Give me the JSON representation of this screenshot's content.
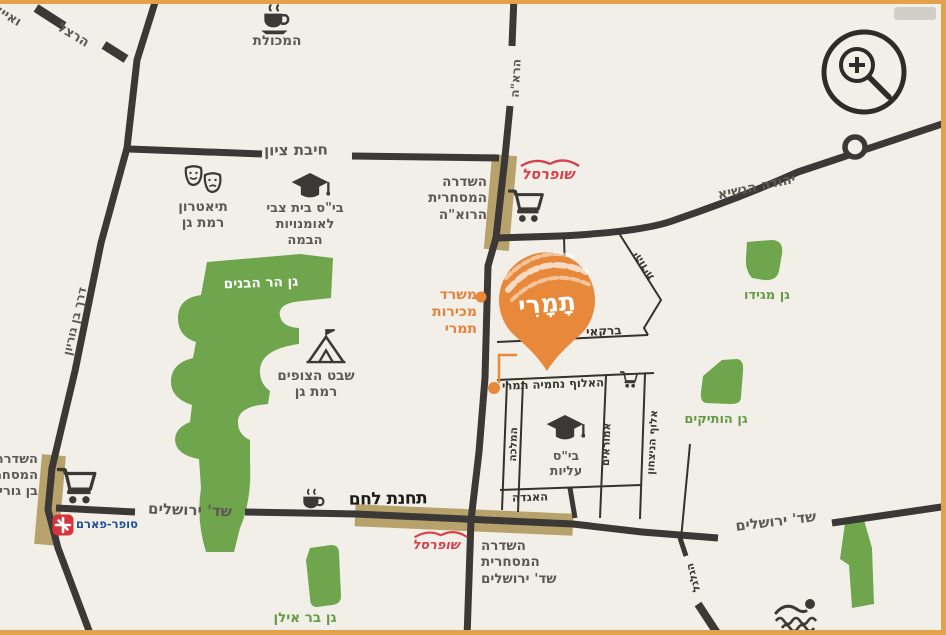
{
  "streets": {
    "ayalon": "ואיילון",
    "herzl": "הרצל",
    "hibat_zion": "חיבת ציון",
    "haroe": "הרא\"ה",
    "yehuda_hanasi": "יהודה הנשיא",
    "ben_gurion": "דרך בן גוריון",
    "barkai": "ברקאי",
    "yehudit": "יהודית",
    "nahmia_tamari": "האלוף נחמיה תמרי",
    "hamalka": "המלכה",
    "amoraim": "אמוראים",
    "aluf_hanitzachon": "אלוף הניצחון",
    "haagada": "האגדה",
    "jerusalem_left": "שד' ירושלים",
    "jerusalem_right": "שד' ירושלים",
    "hagalgal": "הגלגל"
  },
  "places": {
    "hamakolet": "המכולת",
    "theater": "תיאטרון\nרמת גן",
    "beit_zvi": "בי\"ס בית צבי\nלאומנויות\nהבמה",
    "shufersal_top": "שופרסל",
    "shufersal_bottom": "שופרסל",
    "promenade_haroe": "השדרה\nהמסחרית\nהרוא\"ה",
    "sales_office": "משרד\nמכירות\nתמרי",
    "gan_har_habanim": "גן הר הבנים",
    "scouts": "שבט הצופים\nרמת גן",
    "gan_megido": "גן מגידו",
    "gan_havatikim": "גן הותיקים",
    "school_aliyot": "בי\"ס\nעליות",
    "tahanat_lehem": "תחנת לחם",
    "promenade_jerusalem": "השדרה\nהמסחרית\nשד' ירושלים",
    "promenade_ben_gurion": "השדרה\nהמסחרית\nבן גוריון",
    "super_pharm": "סופר-פארם",
    "gan_bar_ilan": "גן בר אילן"
  },
  "pin": {
    "label": "תָמָרִי"
  },
  "colors": {
    "accent_orange": "#E8883A",
    "park_green": "#6FA54C",
    "road_dark": "#3B3835",
    "highlight_tan": "#B49E66",
    "brand_red": "#D5404A",
    "superpharm_blue": "#1E4F9C",
    "border_orange": "#E2A14B"
  },
  "icons": {
    "zoom_in": "zoom-in-icon",
    "cart": "cart-icon",
    "graduation_cap": "graduation-cap-icon",
    "coffee_cup": "coffee-cup-icon",
    "theater_masks": "theater-masks-icon",
    "tent": "tent-icon",
    "swimmer": "swimmer-icon",
    "location_pin": "location-pin-icon",
    "roundabout": "roundabout-icon",
    "super_pharm_cross": "super-pharm-icon",
    "shufersal_swoosh": "shufersal-swoosh-icon"
  }
}
